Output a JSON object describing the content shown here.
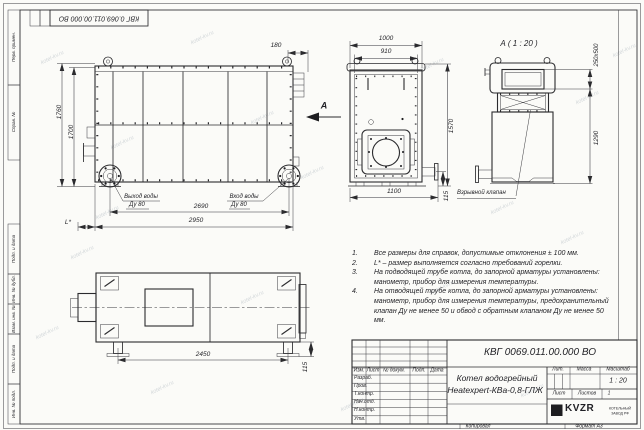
{
  "watermark": "kotel-kv.ru",
  "frame": {
    "top_doc_number": "КВГ 0.069.011.00.000 ВО",
    "margin_labels": [
      "Перв. примен.",
      "Справ. №",
      "Подп. и дата",
      "Инв. № дубл.",
      "Взам. инв. №",
      "Подп. и дата",
      "Инв. № подл."
    ]
  },
  "views": {
    "side": {
      "dims": {
        "d180": "180",
        "d1760": "1760",
        "d1700": "1700",
        "d2690": "2690",
        "d2950": "2950",
        "dL": "L*"
      },
      "labels": {
        "outlet_line1": "Выход воды",
        "outlet_line2": "Ду 80",
        "inlet_line1": "Вход воды",
        "inlet_line2": "Ду 80"
      }
    },
    "front": {
      "dims": {
        "d1000": "1000",
        "d910": "910",
        "d1570": "1570",
        "d1100": "1100",
        "d115": "115"
      },
      "arrow_label": "А"
    },
    "section": {
      "title": "А ( 1 : 20 )",
      "dims": {
        "d250x500": "250х500",
        "d1290": "1290"
      },
      "valve_label": "Взрывной клапан"
    },
    "top": {
      "dims": {
        "d2450": "2450",
        "d115": "115"
      }
    }
  },
  "notes": [
    {
      "num": "1.",
      "text": "Все размеры для справок, допустимые отклонения ± 100 мм."
    },
    {
      "num": "2.",
      "text": "L* – размер выполняется согласно требований горелки."
    },
    {
      "num": "3.",
      "text": "На подводящей трубе котла, до запорной арматуры установлены: манометр, прибор для измерения температуры."
    },
    {
      "num": "4.",
      "text": "На отводящей трубе котла, до запорной арматуры установлены: манометр, прибор для измерения температуры, предохранительный клапан Ду не менее 50 и обвод с обратным клапаном Ду не менее 50 мм."
    }
  ],
  "title_block": {
    "doc_number": "КВГ 0069.011.00.000 ВО",
    "name_line1": "Котел водогрейный",
    "name_line2": "Heatexpert-КВа-0,8-ГЛЖ",
    "scale": "1 : 20",
    "sheets_value": "1",
    "headers": {
      "izm": "Изм.",
      "list": "Лист",
      "doc": "№ докум.",
      "podp": "Подп.",
      "data": "Дата",
      "lit": "Лит.",
      "massa": "Масса",
      "masshtab": "Масштаб",
      "list2": "Лист",
      "listov": "Листов"
    },
    "rows": [
      "Разраб.",
      "Пров.",
      "Т.контр.",
      "Нач.отд.",
      "Н.контр.",
      "Утв."
    ],
    "logo_text": "KVZR",
    "logo_sub1": "КОТЕЛЬНЫЙ",
    "logo_sub2": "ЗАВОД РФ",
    "footer_left": "Копировал",
    "footer_right": "Формат А3"
  }
}
